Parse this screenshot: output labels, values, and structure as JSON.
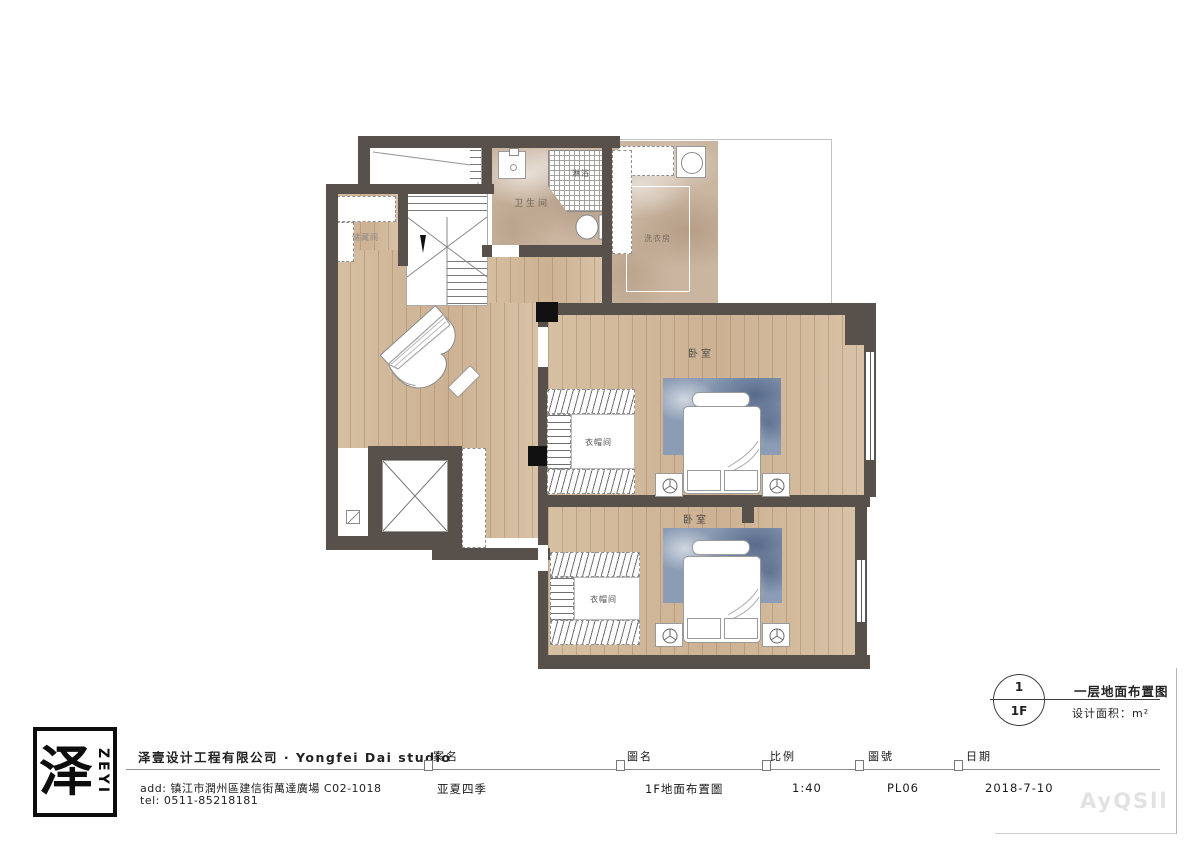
{
  "plan": {
    "storage_label": "储藏间",
    "bathroom_label": "卫生间",
    "shower_label": "淋浴",
    "laundry_label": "洗衣房",
    "bedroom1_label": "卧室",
    "bedroom2_label": "卧室",
    "closet1_label": "衣帽间",
    "closet2_label": "衣帽间"
  },
  "detail_callout": {
    "number": "1",
    "level": "1F",
    "title": "一层地面布置图",
    "area": "设计面积：m²"
  },
  "titleblock": {
    "logo_char": "泽",
    "logo_brand": "ZEYI",
    "company": "泽壹设计工程有限公司 · Yongfei Dai studio",
    "address": "add: 镇江市潤州區建信街萬達廣場 C02-1018",
    "tel": "tel: 0511-85218181",
    "fields": [
      {
        "label": "案名",
        "value": "亚夏四季"
      },
      {
        "label": "圖名",
        "value": "1F地面布置圖"
      },
      {
        "label": "比例",
        "value": "1:40"
      },
      {
        "label": "圖號",
        "value": "PL06"
      },
      {
        "label": "日期",
        "value": "2018-7-10"
      }
    ]
  },
  "watermark": "AyQSll",
  "colors": {
    "wall": "#57504b",
    "wood": "#cdb193",
    "marble": "#c9b5a0",
    "rug": "#8b9cb4"
  }
}
